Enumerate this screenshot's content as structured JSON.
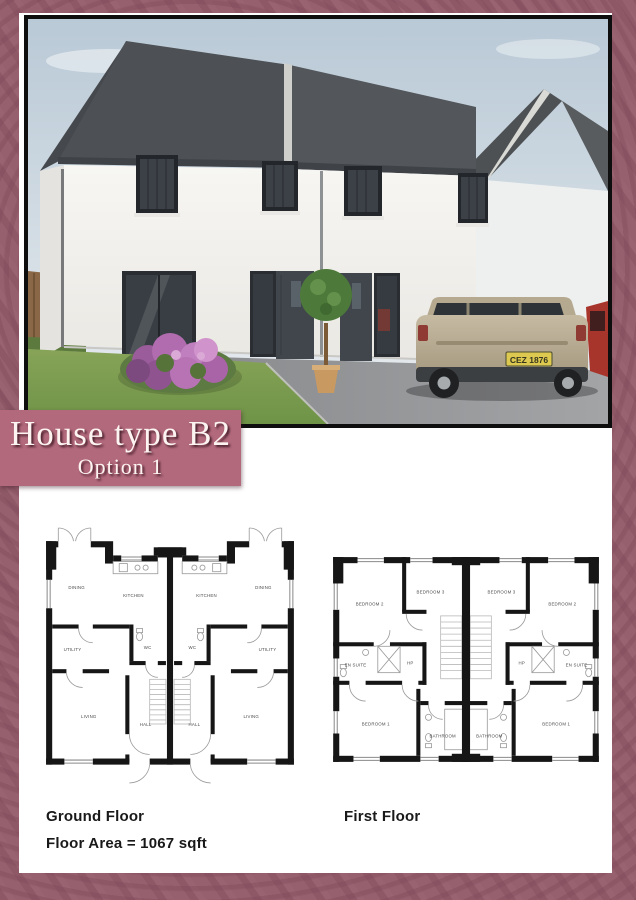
{
  "banner": {
    "title": "House type B2",
    "subtitle": "Option 1",
    "bg_color": "#b2697c"
  },
  "page_colors": {
    "border": "#96606e",
    "panel": "#ffffff",
    "photo_frame": "#0e0e0e"
  },
  "photo": {
    "description": "3D render of white semi-detached two-storey house with grey roof, car on driveway",
    "car_plate": "CEZ 1876"
  },
  "captions": {
    "ground_floor": "Ground Floor",
    "floor_area": "Floor Area = 1067 sqft",
    "first_floor": "First Floor"
  },
  "ground_floor_plan": {
    "rooms": [
      "DINING",
      "KITCHEN",
      "KITCHEN",
      "DINING",
      "UTILITY",
      "WC",
      "WC",
      "UTILITY",
      "LIVING",
      "HALL",
      "HALL",
      "LIVING"
    ]
  },
  "first_floor_plan": {
    "rooms": [
      "BEDROOM 2",
      "BEDROOM 3",
      "BEDROOM 3",
      "BEDROOM 2",
      "EN SUITE",
      "HP",
      "HP",
      "EN SUITE",
      "BEDROOM 1",
      "BATHROOM",
      "BATHROOM",
      "BEDROOM 1"
    ]
  }
}
